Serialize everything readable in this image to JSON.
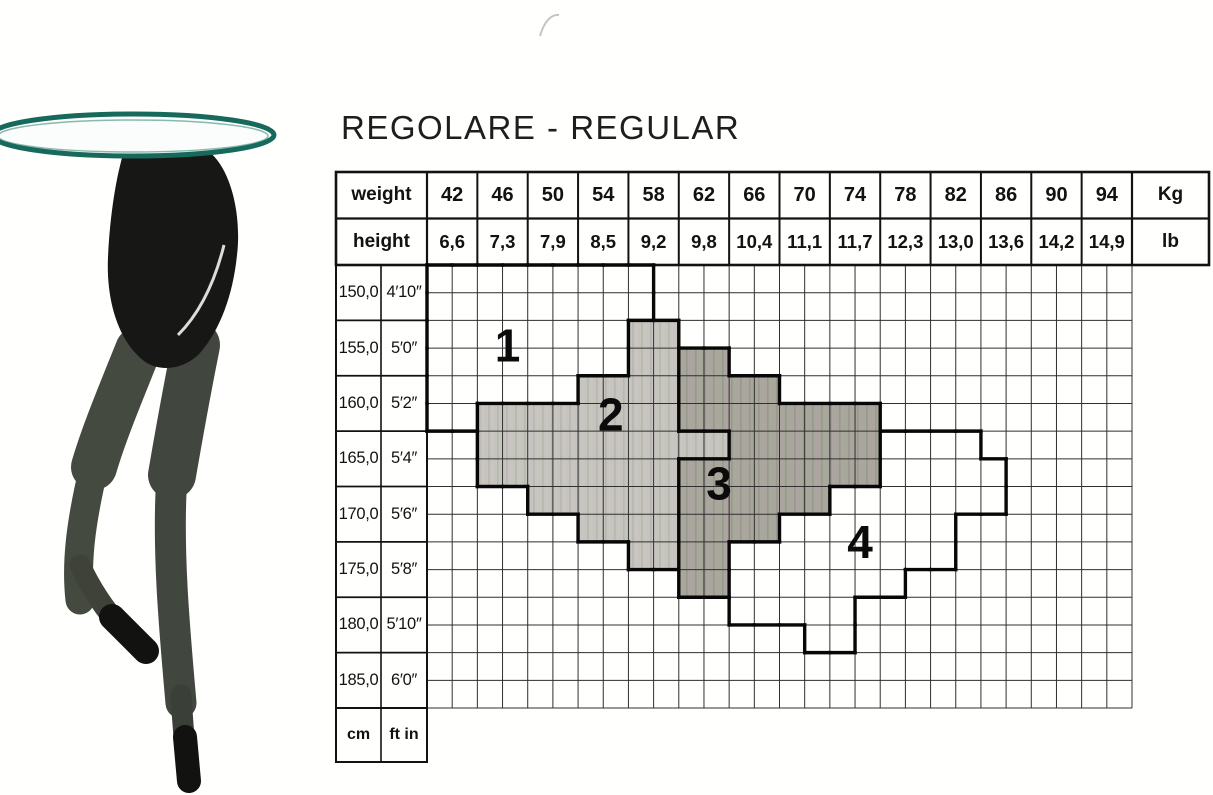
{
  "title": "REGOLARE - REGULAR",
  "header": {
    "weight_label": "weight",
    "weight_unit": "Kg",
    "weights": [
      "42",
      "46",
      "50",
      "54",
      "58",
      "62",
      "66",
      "70",
      "74",
      "78",
      "82",
      "86",
      "90",
      "94"
    ],
    "height_label": "height",
    "height_unit": "lb",
    "height_values": [
      "6,6",
      "7,3",
      "7,9",
      "8,5",
      "9,2",
      "9,8",
      "10,4",
      "11,1",
      "11,7",
      "12,3",
      "13,0",
      "13,6",
      "14,2",
      "14,9"
    ]
  },
  "height_rows": [
    {
      "cm": "150,0",
      "ftin": "4′10″"
    },
    {
      "cm": "155,0",
      "ftin": "5′0″"
    },
    {
      "cm": "160,0",
      "ftin": "5′2″"
    },
    {
      "cm": "165,0",
      "ftin": "5′4″"
    },
    {
      "cm": "170,0",
      "ftin": "5′6″"
    },
    {
      "cm": "175,0",
      "ftin": "5′8″"
    },
    {
      "cm": "180,0",
      "ftin": "5′10″"
    },
    {
      "cm": "185,0",
      "ftin": "6′0″"
    }
  ],
  "footer": {
    "cm_label": "cm",
    "ftin_label": "ft in"
  },
  "colors": {
    "grid_thin": "#2f2f2f",
    "grid_thick": "#070707",
    "zone2_fill": "#c6c5bd",
    "zone3_fill": "#a8a79c",
    "table_teal": "#17695c",
    "tights_dark": "#171715",
    "tights_leg": "#41463e"
  },
  "chart_data": {
    "type": "heatmap",
    "title": "REGOLARE - REGULAR",
    "x_categories_kg": [
      42,
      46,
      50,
      54,
      58,
      62,
      66,
      70,
      74,
      78,
      82,
      86,
      90,
      94
    ],
    "x_categories_lb_stones": [
      "6,6",
      "7,3",
      "7,9",
      "8,5",
      "9,2",
      "9,8",
      "10,4",
      "11,1",
      "11,7",
      "12,3",
      "13,0",
      "13,6",
      "14,2",
      "14,9"
    ],
    "y_categories_cm": [
      "150,0",
      "155,0",
      "160,0",
      "165,0",
      "170,0",
      "175,0",
      "180,0",
      "185,0"
    ],
    "y_categories_ftin": [
      "4′10″",
      "5′0″",
      "5′2″",
      "5′4″",
      "5′6″",
      "5′8″",
      "5′10″",
      "6′0″"
    ],
    "grid": "28 half-columns x 16 half-rows; each weight column = 2 half-columns, each height row = 2 half-rows",
    "legend_note": "zones 1 and 4 are outlined white regions; zone 2 light grey shading; zone 3 darker grey shading",
    "zones": [
      {
        "id": "1",
        "label": "1",
        "fill": "none",
        "label_cell": [
          3.2,
          2.9
        ],
        "cells": [
          [
            0,
            0,
            8
          ],
          [
            1,
            0,
            8
          ],
          [
            2,
            0,
            7
          ],
          [
            3,
            0,
            7
          ],
          [
            4,
            0,
            5
          ],
          [
            5,
            0,
            1
          ]
        ]
      },
      {
        "id": "2",
        "label": "2",
        "fill": "zone2_fill",
        "label_cell": [
          7.3,
          5.4
        ],
        "cells": [
          [
            2,
            8,
            9
          ],
          [
            3,
            8,
            9
          ],
          [
            4,
            6,
            9
          ],
          [
            5,
            2,
            9
          ],
          [
            6,
            2,
            11
          ],
          [
            7,
            2,
            9
          ],
          [
            8,
            4,
            9
          ],
          [
            9,
            6,
            9
          ],
          [
            10,
            8,
            9
          ]
        ]
      },
      {
        "id": "3",
        "label": "3",
        "fill": "zone3_fill",
        "label_cell": [
          11.6,
          7.9
        ],
        "cells": [
          [
            3,
            10,
            11
          ],
          [
            4,
            10,
            13
          ],
          [
            5,
            10,
            17
          ],
          [
            6,
            12,
            17
          ],
          [
            7,
            10,
            17
          ],
          [
            8,
            10,
            15
          ],
          [
            9,
            10,
            13
          ],
          [
            10,
            10,
            11
          ],
          [
            11,
            10,
            11
          ]
        ]
      },
      {
        "id": "4",
        "label": "4",
        "fill": "none",
        "label_cell": [
          17.2,
          10.0
        ],
        "cells": [
          [
            6,
            18,
            21
          ],
          [
            7,
            18,
            22
          ],
          [
            8,
            16,
            22
          ],
          [
            9,
            14,
            20
          ],
          [
            10,
            12,
            20
          ],
          [
            11,
            12,
            18
          ],
          [
            12,
            12,
            16
          ],
          [
            13,
            15,
            16
          ]
        ]
      }
    ]
  }
}
